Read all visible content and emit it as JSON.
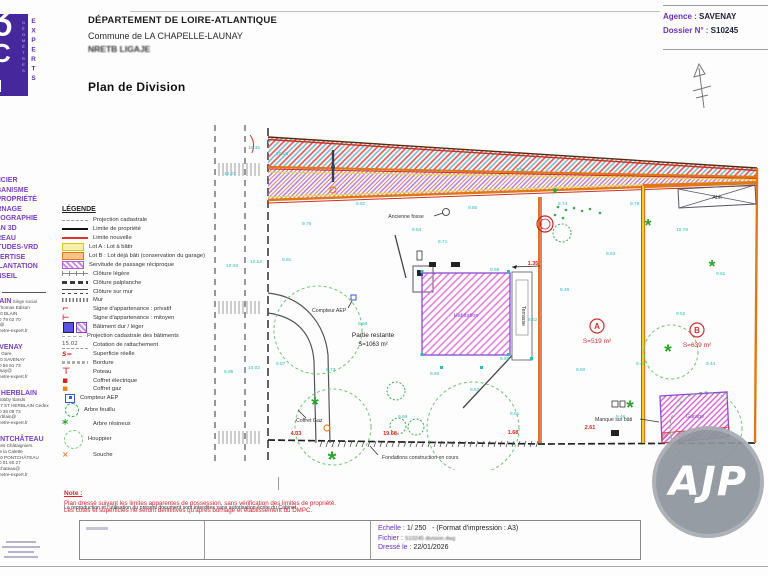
{
  "header": {
    "department": "DÉPARTEMENT DE LOIRE-ATLANTIQUE",
    "commune": "Commune de LA CHAPELLE-LAUNAY",
    "lieu": "NRETB LIGAJE",
    "title": "Plan de Division",
    "agence_label": "Agence :",
    "agence_value": "SAVENAY",
    "dossier_label": "Dossier N° :",
    "dossier_value": "S10245"
  },
  "logo": {
    "mark1": "Ʒ",
    "mark2": "C",
    "geometres": "GÉOMÈTRES",
    "experts": "EXPERTS"
  },
  "sidebar": {
    "services": [
      "FONCIER",
      "URBANISME",
      "COPROPRIÉTÉ",
      "BORNAGE",
      "TOPOGRAPHIE",
      "SCAN 3D",
      "BUREAU",
      "D'ÉTUDES-VRD",
      "EXPERTISE",
      "IMPLANTATION",
      "CONSEIL"
    ],
    "offices": [
      {
        "name": "BLAIN",
        "tag": "Siège social",
        "lines": [
          "rue Thomas Edison",
          "44130 BLAIN",
          "02 40 79 02 70",
          "blain@",
          "geometre-expert.fr"
        ]
      },
      {
        "name": "SAVENAY",
        "tag": "",
        "lines": [
          "de la Gare",
          "44260 SAVENAY",
          "02 40 56 91 73",
          "savenay@",
          "geometre-expert.fr"
        ]
      },
      {
        "name": "ST HERBLAIN",
        "tag": "",
        "lines": [
          "rue Bobby Sands",
          "44817 ST HERBLAIN Cedex",
          "02 40 38 09 73",
          "st-herblain@",
          "geometre-expert.fr"
        ]
      },
      {
        "name": "PONTCHÂTEAU",
        "tag": "",
        "lines": [
          "rue des Châtaigniers",
          "ZA de la Calette",
          "44160 PONTCHÂTEAU",
          "02 40 01 60 27",
          "pontchateau@",
          "geometre-expert.fr"
        ]
      }
    ]
  },
  "legend": {
    "title": "LÉGENDE",
    "items": [
      {
        "s": "dashgray",
        "t": "Projection cadastrale"
      },
      {
        "s": "lineblack",
        "t": "Limite de propriété"
      },
      {
        "s": "linered",
        "t": "Limite nouvelle"
      },
      {
        "s": "boxyellow",
        "t": "Lot A : Lot à bâtir"
      },
      {
        "s": "boxorange",
        "t": "Lot B : Lot déjà bâti (conservation du garage)"
      },
      {
        "s": "boxviolet",
        "t": "Servitude de passage réciproque"
      },
      {
        "s": "fence1",
        "t": "Clôture légère"
      },
      {
        "s": "fence2",
        "t": "Clôture palplanche"
      },
      {
        "s": "fence3",
        "t": "Clôture sur mur"
      },
      {
        "s": "mur",
        "t": "Mur"
      },
      {
        "s": "sign-priv",
        "t": "Signe d'appartenance : privatif"
      },
      {
        "s": "sign-mit",
        "t": "Signe d'appartenance : mitoyen"
      },
      {
        "s": "bldg",
        "t": "Bâtiment dur / léger"
      },
      {
        "s": "projbldg",
        "t": "Projection cadastrale des bâtiments"
      },
      {
        "s": "cote",
        "t": "Cotation de rattachement"
      },
      {
        "s": "sup",
        "t": "Superficie réelle"
      },
      {
        "s": "bordure",
        "t": "Bordure"
      },
      {
        "s": "poteau",
        "t": "Poteau"
      },
      {
        "s": "coffret-e",
        "t": "Coffret électrique"
      },
      {
        "s": "coffret-g",
        "t": "Coffret gaz"
      },
      {
        "s": "compteur",
        "t": "Compteur AEP"
      },
      {
        "s": "feuillu",
        "t": "Arbre feuillu"
      },
      {
        "s": "resineux",
        "t": "Arbre résineux"
      },
      {
        "s": "houppier",
        "t": "Houppier"
      },
      {
        "s": "souche",
        "t": "Souche"
      }
    ]
  },
  "plan": {
    "labels": {
      "habitation": "Habitation",
      "terrasse": "Terrasse",
      "garage": "Garage",
      "abri": "Abri",
      "fosse": "Ancienne fosse",
      "compteur": "Compteur AEP",
      "coffret": "Coffret Gaz",
      "manque": "Manque sur bâti",
      "fondations": "Fondations construction en cours"
    },
    "lots": {
      "rest1": "Partie restante",
      "rest2": "S=1063 m²",
      "a_letter": "A",
      "a_surface": "S=519 m²",
      "b_letter": "B",
      "b_surface": "S=639 m²"
    },
    "dims": [
      {
        "x": 86,
        "y": 320,
        "v": "4.33"
      },
      {
        "x": 180,
        "y": 320,
        "v": "19.68"
      },
      {
        "x": 303,
        "y": 319,
        "v": "1.68"
      },
      {
        "x": 380,
        "y": 314,
        "v": "2.61"
      },
      {
        "x": 323,
        "y": 150,
        "v": "1.35"
      }
    ],
    "spots": [
      {
        "x": 14,
        "y": 60,
        "v": "10.21"
      },
      {
        "x": 38,
        "y": 34,
        "v": "10.35"
      },
      {
        "x": 16,
        "y": 152,
        "v": "10.08"
      },
      {
        "x": 40,
        "y": 148,
        "v": "10.12"
      },
      {
        "x": 14,
        "y": 258,
        "v": "9.95"
      },
      {
        "x": 38,
        "y": 254,
        "v": "10.02"
      },
      {
        "x": 66,
        "y": 40,
        "v": "10.18"
      },
      {
        "x": 72,
        "y": 146,
        "v": "9.91"
      },
      {
        "x": 66,
        "y": 250,
        "v": "9.87"
      },
      {
        "x": 92,
        "y": 110,
        "v": "9.76"
      },
      {
        "x": 146,
        "y": 90,
        "v": "9.82"
      },
      {
        "x": 202,
        "y": 116,
        "v": "9.64"
      },
      {
        "x": 228,
        "y": 128,
        "v": "9.71"
      },
      {
        "x": 258,
        "y": 94,
        "v": "9.80"
      },
      {
        "x": 306,
        "y": 56,
        "v": "9.92"
      },
      {
        "x": 348,
        "y": 90,
        "v": "9.74"
      },
      {
        "x": 280,
        "y": 156,
        "v": "9.58"
      },
      {
        "x": 318,
        "y": 206,
        "v": "9.62"
      },
      {
        "x": 290,
        "y": 245,
        "v": "9.55"
      },
      {
        "x": 220,
        "y": 260,
        "v": "9.60"
      },
      {
        "x": 148,
        "y": 210,
        "v": "9.68"
      },
      {
        "x": 116,
        "y": 256,
        "v": "9.73"
      },
      {
        "x": 188,
        "y": 303,
        "v": "9.66"
      },
      {
        "x": 260,
        "y": 276,
        "v": "9.57"
      },
      {
        "x": 350,
        "y": 176,
        "v": "9.49"
      },
      {
        "x": 396,
        "y": 140,
        "v": "9.53"
      },
      {
        "x": 420,
        "y": 90,
        "v": "9.78"
      },
      {
        "x": 466,
        "y": 116,
        "v": "10.78"
      },
      {
        "x": 506,
        "y": 160,
        "v": "9.61"
      },
      {
        "x": 466,
        "y": 200,
        "v": "9.52"
      },
      {
        "x": 426,
        "y": 250,
        "v": "9.47"
      },
      {
        "x": 496,
        "y": 250,
        "v": "9.44"
      },
      {
        "x": 366,
        "y": 256,
        "v": "9.50"
      },
      {
        "x": 406,
        "y": 303,
        "v": "9.46"
      },
      {
        "x": 300,
        "y": 300,
        "v": "9.51"
      }
    ],
    "trees": {
      "houppier": [
        {
          "x": 108,
          "y": 215,
          "r": 44
        },
        {
          "x": 123,
          "y": 312,
          "r": 38
        },
        {
          "x": 263,
          "y": 313,
          "r": 46
        },
        {
          "x": 461,
          "y": 237,
          "r": 27
        },
        {
          "x": 496,
          "y": 313,
          "r": 36
        }
      ],
      "feuillu": [
        {
          "x": 188,
          "y": 311,
          "r": 8
        },
        {
          "x": 206,
          "y": 312,
          "r": 8
        },
        {
          "x": 352,
          "y": 118,
          "r": 9
        },
        {
          "x": 186,
          "y": 276,
          "r": 9
        }
      ],
      "resineux": [
        {
          "x": 105,
          "y": 292,
          "s": 12
        },
        {
          "x": 122,
          "y": 347,
          "s": 14
        },
        {
          "x": 420,
          "y": 295,
          "s": 12
        },
        {
          "x": 438,
          "y": 112,
          "s": 11
        },
        {
          "x": 502,
          "y": 153,
          "s": 11
        },
        {
          "x": 458,
          "y": 239,
          "s": 12
        },
        {
          "x": 345,
          "y": 80,
          "s": 9
        }
      ],
      "dots": [
        {
          "x": 348,
          "y": 92
        },
        {
          "x": 356,
          "y": 95
        },
        {
          "x": 364,
          "y": 93
        },
        {
          "x": 372,
          "y": 96
        },
        {
          "x": 380,
          "y": 94
        },
        {
          "x": 345,
          "y": 100
        },
        {
          "x": 353,
          "y": 103
        },
        {
          "x": 390,
          "y": 98
        }
      ]
    },
    "ticks": {
      "x1": 112,
      "x2": 332,
      "y": 326,
      "step": 6
    }
  },
  "notes": {
    "label": "Note :",
    "line1": "Plan dressé suivant les limites apparentes de possession, sans vérification des limites de propriété.",
    "line2": "Les cotes et superficies ne seront définitives qu'après bornage et établissement du DMPC.",
    "disclaimer": "La reproduction et l'utilisation du présent document sont interdites sans autorisation écrite du Cabinet"
  },
  "cartouche": {
    "echelle_label": "Echelle :",
    "echelle_value": "1/ 250",
    "format_value": "- (Format d'impression : A3)",
    "fichier_label": "Fichier :",
    "fichier_value": "S10245 division.dwg",
    "dresse_label": "Dressé le :",
    "dresse_value": "22/01/2026"
  },
  "watermark": {
    "text": "AJP"
  }
}
